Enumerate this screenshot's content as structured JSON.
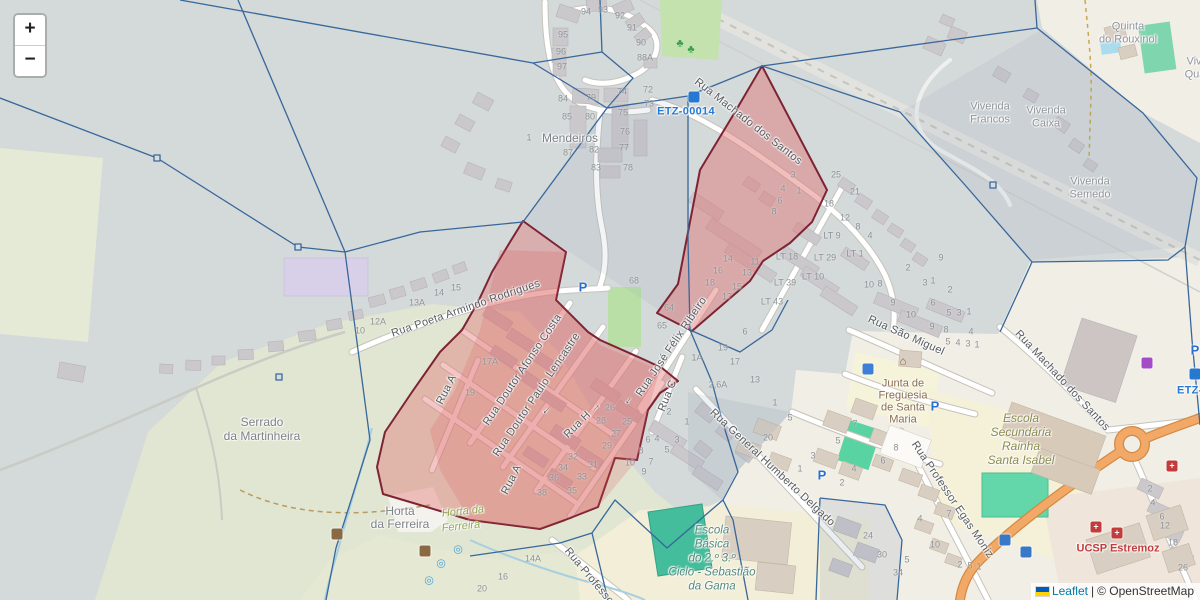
{
  "map": {
    "controls": {
      "zoom_in": "+",
      "zoom_out": "−"
    },
    "attribution": {
      "leaflet": "Leaflet",
      "separator": "|",
      "copyright": "© OpenStreetMap"
    },
    "colors": {
      "highlight_fill": "#e06e6e",
      "highlight_border": "#7d2334",
      "boundary_line": "#38679b",
      "etz_blue": "#2579d0",
      "road_orange": "#f0a862",
      "attribution_link": "#0078a8",
      "base_gray": "#d4d9d9",
      "base_cream": "#f1eee6"
    },
    "etz_labels": [
      {
        "t": "ETZ-00014",
        "x": 686,
        "y": 112
      },
      {
        "t": "ETZ-0",
        "x": 1193,
        "y": 391
      }
    ],
    "street_labels": [
      {
        "t": "Rua Machado dos Santos",
        "x": 748,
        "y": 122,
        "r": 38
      },
      {
        "t": "Rua Poeta Armindo Rodrigues",
        "x": 466,
        "y": 309,
        "r": -19
      },
      {
        "t": "Rua Doutor Afonso Costa",
        "x": 523,
        "y": 370,
        "r": -56
      },
      {
        "t": "Rua Doutor Paulo Lencastre",
        "x": 537,
        "y": 395,
        "r": -56
      },
      {
        "t": "Rua A",
        "x": 447,
        "y": 390,
        "r": -63
      },
      {
        "t": "Rua A",
        "x": 512,
        "y": 480,
        "r": -63
      },
      {
        "t": "Rua H  →",
        "x": 583,
        "y": 420,
        "r": -45
      },
      {
        "t": "←",
        "x": 546,
        "y": 410,
        "r": -45
      },
      {
        "t": "Rua José Félix Ribeiro",
        "x": 672,
        "y": 347,
        "r": -56
      },
      {
        "t": "←",
        "x": 628,
        "y": 400,
        "r": -56
      },
      {
        "t": "Rua C",
        "x": 668,
        "y": 396,
        "r": -68
      },
      {
        "t": "Rua General Humberto Delgado",
        "x": 772,
        "y": 468,
        "r": 43
      },
      {
        "t": "Rua São Miguel",
        "x": 906,
        "y": 336,
        "r": 24
      },
      {
        "t": "Rua Machado dos Santos",
        "x": 1062,
        "y": 381,
        "r": 47
      },
      {
        "t": "Rua Professor Egas Moniz",
        "x": 952,
        "y": 500,
        "r": 56
      },
      {
        "t": "Rua Professor",
        "x": 590,
        "y": 578,
        "r": 50
      }
    ],
    "place_labels": [
      {
        "t": "Mendeiros",
        "x": 570,
        "y": 138,
        "cls": "place"
      },
      {
        "t": "Serrado",
        "x": 262,
        "y": 422,
        "cls": "place"
      },
      {
        "t": "da Martinheira",
        "x": 262,
        "y": 436,
        "cls": "place"
      },
      {
        "t": "Horta",
        "x": 400,
        "y": 511,
        "cls": "place"
      },
      {
        "t": "da Ferreira",
        "x": 400,
        "y": 524,
        "cls": "place"
      },
      {
        "t": "Horta da",
        "x": 463,
        "y": 512,
        "cls": "landuse",
        "r": -6
      },
      {
        "t": "Ferreira",
        "x": 461,
        "y": 527,
        "cls": "landuse",
        "r": -6
      },
      {
        "t": "Escola",
        "x": 712,
        "y": 531,
        "cls": "school"
      },
      {
        "t": "Básica",
        "x": 712,
        "y": 545,
        "cls": "school"
      },
      {
        "t": "do 2.º 3.º",
        "x": 712,
        "y": 559,
        "cls": "school"
      },
      {
        "t": "Ciclo - Sebastião",
        "x": 712,
        "y": 573,
        "cls": "school"
      },
      {
        "t": "da Gama",
        "x": 712,
        "y": 587,
        "cls": "school"
      },
      {
        "t": "Escola",
        "x": 1021,
        "y": 418,
        "cls": "school2"
      },
      {
        "t": "Secundária",
        "x": 1021,
        "y": 432,
        "cls": "school2"
      },
      {
        "t": "Rainha",
        "x": 1021,
        "y": 446,
        "cls": "school2"
      },
      {
        "t": "Santa Isabel",
        "x": 1021,
        "y": 460,
        "cls": "school2"
      },
      {
        "t": "Junta de",
        "x": 903,
        "y": 384,
        "cls": "amenity"
      },
      {
        "t": "Freguesia",
        "x": 903,
        "y": 396,
        "cls": "amenity"
      },
      {
        "t": "de Santa",
        "x": 903,
        "y": 408,
        "cls": "amenity"
      },
      {
        "t": "Maria",
        "x": 903,
        "y": 420,
        "cls": "amenity"
      },
      {
        "t": "UCSP Estremoz",
        "x": 1118,
        "y": 549,
        "cls": "health"
      },
      {
        "t": "Vivenda",
        "x": 990,
        "y": 107,
        "cls": "place2"
      },
      {
        "t": "Francos",
        "x": 990,
        "y": 120,
        "cls": "place2"
      },
      {
        "t": "Vivenda",
        "x": 1046,
        "y": 111,
        "cls": "place2"
      },
      {
        "t": "Caixa",
        "x": 1046,
        "y": 124,
        "cls": "place2"
      },
      {
        "t": "Vivenda",
        "x": 1090,
        "y": 182,
        "cls": "place2"
      },
      {
        "t": "Semedo",
        "x": 1090,
        "y": 195,
        "cls": "place2"
      },
      {
        "t": "Quinta",
        "x": 1128,
        "y": 27,
        "cls": "place2"
      },
      {
        "t": "do Rouxinol",
        "x": 1128,
        "y": 40,
        "cls": "place2"
      },
      {
        "t": "Viv",
        "x": 1194,
        "y": 62,
        "cls": "place2"
      },
      {
        "t": "Qua",
        "x": 1195,
        "y": 75,
        "cls": "place2"
      }
    ],
    "house_numbers": [
      {
        "t": "94",
        "x": 586,
        "y": 12
      },
      {
        "t": "93",
        "x": 603,
        "y": 10
      },
      {
        "t": "92",
        "x": 620,
        "y": 16
      },
      {
        "t": "91",
        "x": 632,
        "y": 28
      },
      {
        "t": "90",
        "x": 641,
        "y": 43
      },
      {
        "t": "88A",
        "x": 645,
        "y": 58
      },
      {
        "t": "95",
        "x": 563,
        "y": 35
      },
      {
        "t": "96",
        "x": 561,
        "y": 52
      },
      {
        "t": "97",
        "x": 562,
        "y": 67
      },
      {
        "t": "84",
        "x": 563,
        "y": 99
      },
      {
        "t": "79",
        "x": 591,
        "y": 98
      },
      {
        "t": "85",
        "x": 567,
        "y": 117
      },
      {
        "t": "80",
        "x": 590,
        "y": 117
      },
      {
        "t": "74",
        "x": 622,
        "y": 92
      },
      {
        "t": "72",
        "x": 648,
        "y": 90
      },
      {
        "t": "73",
        "x": 649,
        "y": 104
      },
      {
        "t": "75",
        "x": 623,
        "y": 113
      },
      {
        "t": "76",
        "x": 625,
        "y": 132
      },
      {
        "t": "77",
        "x": 624,
        "y": 148
      },
      {
        "t": "78",
        "x": 628,
        "y": 168
      },
      {
        "t": "87",
        "x": 568,
        "y": 153
      },
      {
        "t": "82",
        "x": 594,
        "y": 150
      },
      {
        "t": "83",
        "x": 596,
        "y": 168
      },
      {
        "t": "1",
        "x": 529,
        "y": 138
      },
      {
        "t": "3",
        "x": 793,
        "y": 175
      },
      {
        "t": "4",
        "x": 783,
        "y": 189
      },
      {
        "t": "1",
        "x": 799,
        "y": 191
      },
      {
        "t": "6",
        "x": 780,
        "y": 201
      },
      {
        "t": "8",
        "x": 774,
        "y": 212
      },
      {
        "t": "25",
        "x": 836,
        "y": 175
      },
      {
        "t": "21",
        "x": 855,
        "y": 192
      },
      {
        "t": "18",
        "x": 829,
        "y": 204
      },
      {
        "t": "12",
        "x": 845,
        "y": 218
      },
      {
        "t": "8",
        "x": 858,
        "y": 227
      },
      {
        "t": "4",
        "x": 870,
        "y": 236
      },
      {
        "t": "LT 9",
        "x": 832,
        "y": 236
      },
      {
        "t": "LT 1",
        "x": 855,
        "y": 254
      },
      {
        "t": "LT 29",
        "x": 825,
        "y": 258
      },
      {
        "t": "LT 10",
        "x": 813,
        "y": 277
      },
      {
        "t": "LT 18",
        "x": 787,
        "y": 257
      },
      {
        "t": "LT 39",
        "x": 785,
        "y": 283
      },
      {
        "t": "LT 43",
        "x": 772,
        "y": 302
      },
      {
        "t": "10",
        "x": 869,
        "y": 285
      },
      {
        "t": "8",
        "x": 880,
        "y": 284
      },
      {
        "t": "2",
        "x": 908,
        "y": 268
      },
      {
        "t": "3",
        "x": 925,
        "y": 283
      },
      {
        "t": "1",
        "x": 933,
        "y": 281
      },
      {
        "t": "9",
        "x": 941,
        "y": 258
      },
      {
        "t": "2",
        "x": 950,
        "y": 290
      },
      {
        "t": "14",
        "x": 728,
        "y": 259
      },
      {
        "t": "16",
        "x": 718,
        "y": 271
      },
      {
        "t": "18",
        "x": 710,
        "y": 283
      },
      {
        "t": "11",
        "x": 755,
        "y": 262
      },
      {
        "t": "13",
        "x": 747,
        "y": 273
      },
      {
        "t": "15",
        "x": 737,
        "y": 287
      },
      {
        "t": "17",
        "x": 727,
        "y": 297
      },
      {
        "t": "6",
        "x": 745,
        "y": 332
      },
      {
        "t": "19",
        "x": 723,
        "y": 348
      },
      {
        "t": "1A",
        "x": 697,
        "y": 358
      },
      {
        "t": "17",
        "x": 735,
        "y": 362
      },
      {
        "t": "2,6A",
        "x": 718,
        "y": 385
      },
      {
        "t": "13",
        "x": 755,
        "y": 380
      },
      {
        "t": "1",
        "x": 775,
        "y": 403
      },
      {
        "t": "64",
        "x": 669,
        "y": 308
      },
      {
        "t": "65",
        "x": 662,
        "y": 326
      },
      {
        "t": "68",
        "x": 634,
        "y": 281
      },
      {
        "t": "10",
        "x": 360,
        "y": 331
      },
      {
        "t": "12A",
        "x": 378,
        "y": 322
      },
      {
        "t": "13A",
        "x": 417,
        "y": 303
      },
      {
        "t": "14",
        "x": 439,
        "y": 293
      },
      {
        "t": "15",
        "x": 456,
        "y": 288
      },
      {
        "t": "17A",
        "x": 490,
        "y": 362
      },
      {
        "t": "19",
        "x": 470,
        "y": 393
      },
      {
        "t": "26",
        "x": 610,
        "y": 408
      },
      {
        "t": "28",
        "x": 601,
        "y": 421
      },
      {
        "t": "25",
        "x": 627,
        "y": 422
      },
      {
        "t": "27",
        "x": 616,
        "y": 434
      },
      {
        "t": "29",
        "x": 607,
        "y": 446
      },
      {
        "t": "32",
        "x": 573,
        "y": 457
      },
      {
        "t": "34",
        "x": 563,
        "y": 468
      },
      {
        "t": "31",
        "x": 593,
        "y": 465
      },
      {
        "t": "36",
        "x": 554,
        "y": 478
      },
      {
        "t": "33",
        "x": 582,
        "y": 477
      },
      {
        "t": "35",
        "x": 572,
        "y": 491
      },
      {
        "t": "38",
        "x": 542,
        "y": 493
      },
      {
        "t": "2",
        "x": 669,
        "y": 412
      },
      {
        "t": "1",
        "x": 687,
        "y": 422
      },
      {
        "t": "3",
        "x": 677,
        "y": 440
      },
      {
        "t": "4",
        "x": 657,
        "y": 439
      },
      {
        "t": "6",
        "x": 648,
        "y": 440
      },
      {
        "t": "5",
        "x": 667,
        "y": 450
      },
      {
        "t": "8",
        "x": 641,
        "y": 451
      },
      {
        "t": "7",
        "x": 651,
        "y": 462
      },
      {
        "t": "10",
        "x": 630,
        "y": 463
      },
      {
        "t": "9",
        "x": 644,
        "y": 472
      },
      {
        "t": "9",
        "x": 893,
        "y": 303
      },
      {
        "t": "6",
        "x": 933,
        "y": 303
      },
      {
        "t": "10",
        "x": 911,
        "y": 315
      },
      {
        "t": "5",
        "x": 949,
        "y": 313
      },
      {
        "t": "3",
        "x": 959,
        "y": 313
      },
      {
        "t": "1",
        "x": 969,
        "y": 312
      },
      {
        "t": "9",
        "x": 932,
        "y": 327
      },
      {
        "t": "8",
        "x": 946,
        "y": 330
      },
      {
        "t": "4",
        "x": 971,
        "y": 332
      },
      {
        "t": "5",
        "x": 948,
        "y": 342
      },
      {
        "t": "4",
        "x": 958,
        "y": 343
      },
      {
        "t": "3",
        "x": 968,
        "y": 344
      },
      {
        "t": "1",
        "x": 977,
        "y": 345
      },
      {
        "t": "5",
        "x": 790,
        "y": 418
      },
      {
        "t": "20",
        "x": 768,
        "y": 438
      },
      {
        "t": "3",
        "x": 813,
        "y": 456
      },
      {
        "t": "1",
        "x": 800,
        "y": 469
      },
      {
        "t": "5",
        "x": 838,
        "y": 441
      },
      {
        "t": "7",
        "x": 855,
        "y": 424
      },
      {
        "t": "4",
        "x": 854,
        "y": 469
      },
      {
        "t": "2",
        "x": 842,
        "y": 483
      },
      {
        "t": "6",
        "x": 883,
        "y": 461
      },
      {
        "t": "8",
        "x": 896,
        "y": 448
      },
      {
        "t": "7",
        "x": 949,
        "y": 514
      },
      {
        "t": "4",
        "x": 920,
        "y": 519
      },
      {
        "t": "10",
        "x": 935,
        "y": 545
      },
      {
        "t": "2",
        "x": 960,
        "y": 565
      },
      {
        "t": "5",
        "x": 970,
        "y": 566
      },
      {
        "t": "1",
        "x": 979,
        "y": 567
      },
      {
        "t": "24",
        "x": 868,
        "y": 536
      },
      {
        "t": "30",
        "x": 882,
        "y": 555
      },
      {
        "t": "5",
        "x": 907,
        "y": 560
      },
      {
        "t": "34",
        "x": 898,
        "y": 573
      },
      {
        "t": "2",
        "x": 1150,
        "y": 489
      },
      {
        "t": "4",
        "x": 1153,
        "y": 503
      },
      {
        "t": "6",
        "x": 1162,
        "y": 517
      },
      {
        "t": "12",
        "x": 1165,
        "y": 526
      },
      {
        "t": "18",
        "x": 1173,
        "y": 543
      },
      {
        "t": "26",
        "x": 1183,
        "y": 568
      },
      {
        "t": "14A",
        "x": 533,
        "y": 559
      },
      {
        "t": "16",
        "x": 503,
        "y": 577
      },
      {
        "t": "20",
        "x": 482,
        "y": 589
      }
    ],
    "icons": [
      {
        "name": "parking-icon",
        "kind": "p",
        "x": 583,
        "y": 287,
        "t": "P"
      },
      {
        "name": "parking-icon",
        "kind": "p",
        "x": 822,
        "y": 475,
        "t": "P"
      },
      {
        "name": "parking-icon",
        "kind": "p",
        "x": 935,
        "y": 406,
        "t": "P"
      },
      {
        "name": "parking-icon",
        "kind": "p",
        "x": 1195,
        "y": 350,
        "t": "P"
      },
      {
        "name": "etz-marker-icon",
        "kind": "chip",
        "x": 694,
        "y": 97,
        "bg": "#2579d0",
        "t": ""
      },
      {
        "name": "etz-marker-icon",
        "kind": "chip",
        "x": 1195,
        "y": 374,
        "bg": "#2579d0",
        "t": ""
      },
      {
        "name": "drinking-water-icon",
        "kind": "chip",
        "x": 868,
        "y": 369,
        "bg": "#3d7fd4",
        "t": ""
      },
      {
        "name": "townhall-icon",
        "kind": "glyph",
        "x": 903,
        "y": 362,
        "t": "⌂",
        "color": "#7a5a38"
      },
      {
        "name": "bus-stop-icon",
        "kind": "chip",
        "x": 1005,
        "y": 540,
        "bg": "#3878c7",
        "t": ""
      },
      {
        "name": "bus-stop-icon",
        "kind": "chip",
        "x": 1026,
        "y": 552,
        "bg": "#3878c7",
        "t": ""
      },
      {
        "name": "hospital-icon",
        "kind": "chip",
        "x": 1096,
        "y": 527,
        "bg": "#c23c3c",
        "t": "+"
      },
      {
        "name": "hospital-icon",
        "kind": "chip",
        "x": 1117,
        "y": 533,
        "bg": "#c23c3c",
        "t": "+"
      },
      {
        "name": "veterinary-icon",
        "kind": "chip",
        "x": 1172,
        "y": 466,
        "bg": "#c23c3c",
        "t": "+"
      },
      {
        "name": "supermarket-cart-icon",
        "kind": "chip",
        "x": 1147,
        "y": 363,
        "bg": "#a44bc8",
        "t": ""
      },
      {
        "name": "tree-icon",
        "kind": "glyph",
        "x": 680,
        "y": 44,
        "t": "♣",
        "color": "#3f9e4d"
      },
      {
        "name": "tree-icon",
        "kind": "glyph",
        "x": 691,
        "y": 50,
        "t": "♣",
        "color": "#3f9e4d"
      },
      {
        "name": "waste-basket-icon",
        "kind": "chip",
        "x": 337,
        "y": 534,
        "bg": "#8a6a42",
        "t": ""
      },
      {
        "name": "waste-basket-icon",
        "kind": "chip",
        "x": 425,
        "y": 551,
        "bg": "#8a6a42",
        "t": ""
      },
      {
        "name": "spring-icon",
        "kind": "glyph",
        "x": 458,
        "y": 550,
        "t": "◎",
        "color": "#4aa3d8"
      },
      {
        "name": "spring-icon",
        "kind": "glyph",
        "x": 441,
        "y": 564,
        "t": "◎",
        "color": "#4aa3d8"
      },
      {
        "name": "spring-icon",
        "kind": "glyph",
        "x": 429,
        "y": 581,
        "t": "◎",
        "color": "#4aa3d8"
      }
    ]
  }
}
